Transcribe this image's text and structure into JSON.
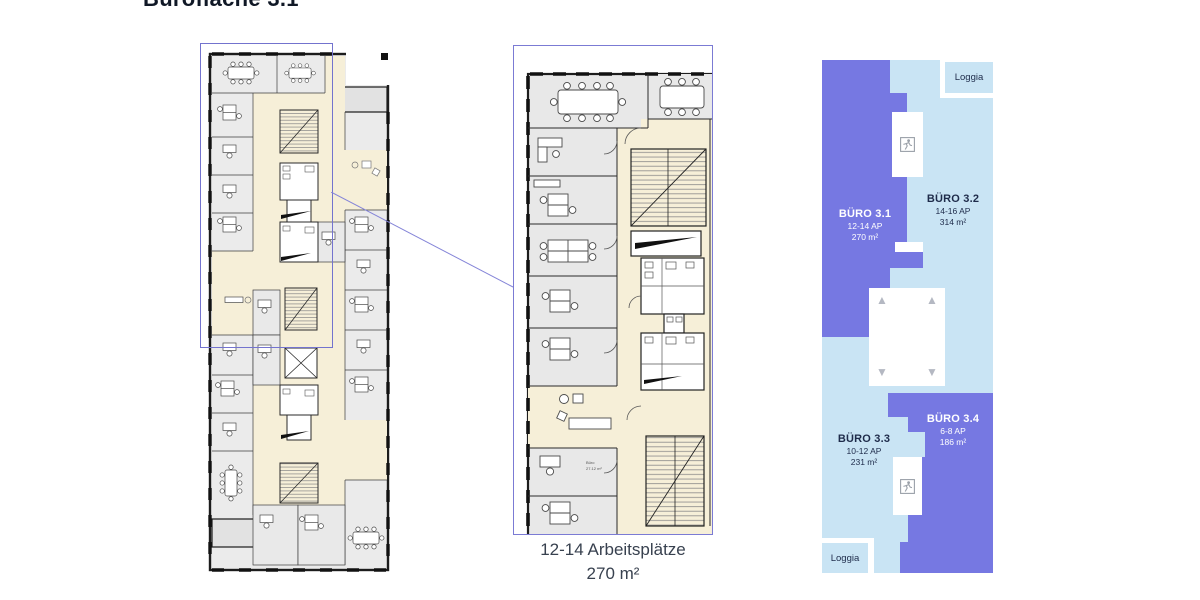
{
  "page": {
    "title": "Bürofläche 3.1"
  },
  "caption": {
    "line1": "12-14 Arbeitsplätze",
    "line2": "270 m²"
  },
  "schematic": {
    "colors": {
      "highlight": "#7678e2",
      "muted": "#c9e4f4",
      "label_dark": "#1e2b4a",
      "label_light": "#ffffff"
    },
    "offices": [
      {
        "name": "BÜRO 3.1",
        "ap": "12-14 AP",
        "area": "270 m²",
        "highlighted": true
      },
      {
        "name": "BÜRO 3.2",
        "ap": "14-16 AP",
        "area": "314 m²",
        "highlighted": false
      },
      {
        "name": "BÜRO 3.3",
        "ap": "10-12 AP",
        "area": "231 m²",
        "highlighted": false
      },
      {
        "name": "BÜRO 3.4",
        "ap": "6-8 AP",
        "area": "186 m²",
        "highlighted": true
      }
    ],
    "loggia_top": "Loggia",
    "loggia_bottom": "Loggia"
  },
  "detail_plan": {
    "room_label_title": "Büro",
    "room_label_area": "27.12 m²"
  }
}
